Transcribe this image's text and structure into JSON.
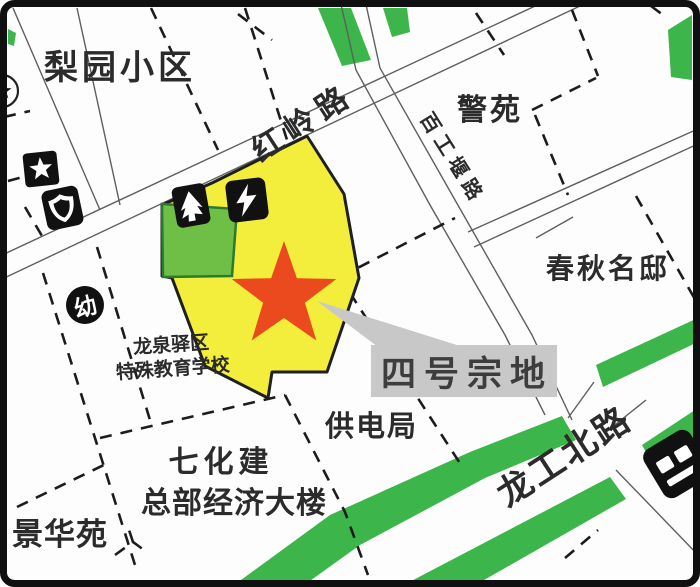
{
  "map": {
    "labels": {
      "liyuan_estate": "梨园小区",
      "hongling_road": "红岭路",
      "jingyuan": "警苑",
      "baigongyan_road": "百工堰路",
      "chunqiu_mansion": "春秋名邸",
      "school_line1": "龙泉驿区",
      "school_line2": "特殊教育学校",
      "parcel_callout": "四号宗地",
      "power_bureau": "供电局",
      "qihuajian_line1": "七化建",
      "qihuajian_line2": "总部经济大楼",
      "jinghuayuan": "景华苑",
      "longgong_north_road": "龙工北路",
      "kindergarten_badge": "幼"
    },
    "icons": [
      "star-badge-icon",
      "shield-badge-icon",
      "kindergarten-icon",
      "tree-icon",
      "lightning-power-icon",
      "station-icon",
      "circle-star-badge-icon"
    ],
    "colors": {
      "parcel_yellow": "#f3ee3b",
      "green_belt": "#3cb54a",
      "sub_parcel_green": "#6fbf46",
      "star_red": "#ea4a1e",
      "callout_gray": "#c8c8c8",
      "line_dark": "#1c1c1c",
      "road_gray": "#5f5f5f"
    }
  }
}
